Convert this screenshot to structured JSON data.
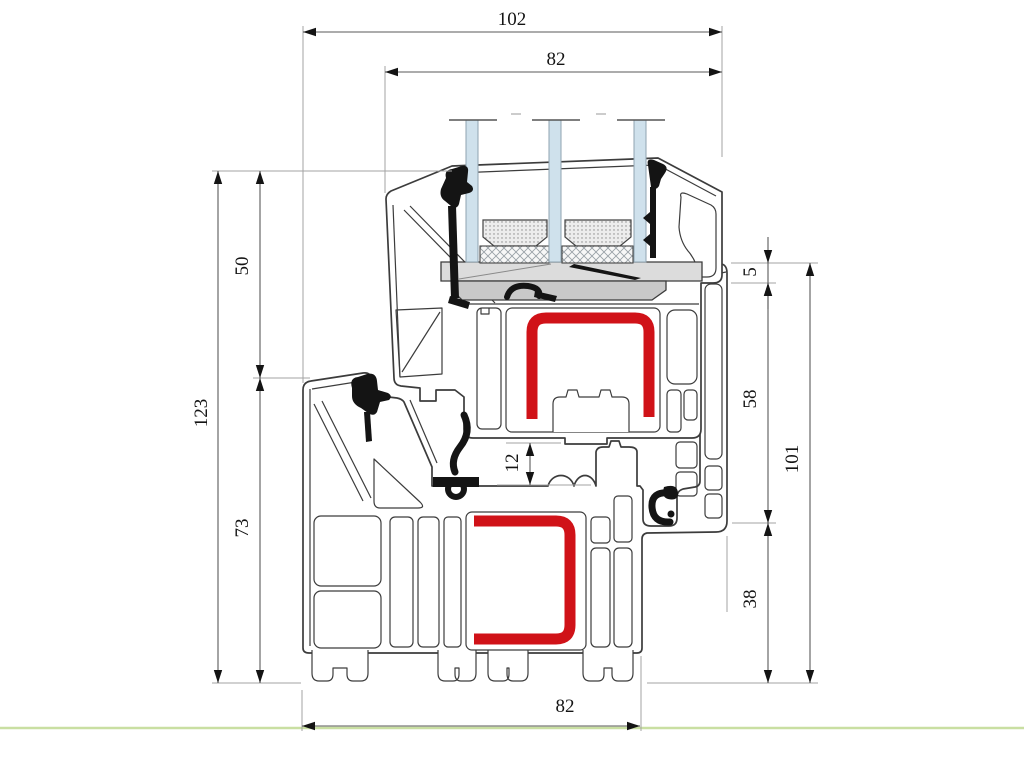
{
  "drawing": {
    "type": "technical-cross-section",
    "subject": "PVC window frame and sash profile with triple glazing and steel reinforcement",
    "units": "mm"
  },
  "colors": {
    "outline": "#3c3c3c",
    "reinforcement_red": "#d01218",
    "glass_blue": "#cfe1ec",
    "glass_edge": "#8fa3b0",
    "packer_gray_light": "#dcdcdc",
    "packer_gray_mid": "#c9c9c9",
    "gasket_black": "#141414",
    "dimension_line": "#5a5a5a",
    "extension_line": "#a3a3a3",
    "ground_green": "#c9dfa2",
    "background": "#ffffff"
  },
  "dimensions": [
    {
      "id": "overall-width-top",
      "value": "102",
      "orientation": "horizontal",
      "x1": 303,
      "x2": 722,
      "y": 32,
      "label_x": 512,
      "label_y": 25,
      "style": "inside"
    },
    {
      "id": "sash-width-top",
      "value": "82",
      "orientation": "horizontal",
      "x1": 385,
      "x2": 722,
      "y": 72,
      "label_x": 556,
      "label_y": 65,
      "style": "inside"
    },
    {
      "id": "total-height-left",
      "value": "123",
      "orientation": "vertical",
      "x": 218,
      "y1": 171,
      "y2": 683,
      "label_x": 207,
      "label_y": 413,
      "style": "inside"
    },
    {
      "id": "upper-height-left",
      "value": "50",
      "orientation": "vertical",
      "x": 260,
      "y1": 171,
      "y2": 378,
      "label_x": 248,
      "label_y": 266,
      "style": "inside"
    },
    {
      "id": "lower-height-left",
      "value": "73",
      "orientation": "vertical",
      "x": 260,
      "y1": 378,
      "y2": 683,
      "label_x": 248,
      "label_y": 528,
      "style": "inside"
    },
    {
      "id": "overlap-right",
      "value": "5",
      "orientation": "vertical",
      "x": 768,
      "y1": 263,
      "y2": 283,
      "label_x": 756,
      "label_y": 272,
      "style": "outside"
    },
    {
      "id": "mid-height-right",
      "value": "58",
      "orientation": "vertical",
      "x": 768,
      "y1": 283,
      "y2": 523,
      "label_x": 756,
      "label_y": 399,
      "style": "inside"
    },
    {
      "id": "lower-height-right",
      "value": "38",
      "orientation": "vertical",
      "x": 768,
      "y1": 523,
      "y2": 683,
      "label_x": 756,
      "label_y": 599,
      "style": "inside"
    },
    {
      "id": "frame-height-right",
      "value": "101",
      "orientation": "vertical",
      "x": 810,
      "y1": 263,
      "y2": 683,
      "label_x": 798,
      "label_y": 459,
      "style": "inside"
    },
    {
      "id": "hardware-gap",
      "value": "12",
      "orientation": "vertical",
      "x": 530,
      "y1": 443,
      "y2": 485,
      "label_x": 518,
      "label_y": 463,
      "style": "inside"
    },
    {
      "id": "frame-width-bottom",
      "value": "82",
      "orientation": "horizontal",
      "x1": 302,
      "x2": 640,
      "y": 726,
      "label_x": 565,
      "label_y": 712,
      "style": "inside"
    }
  ]
}
